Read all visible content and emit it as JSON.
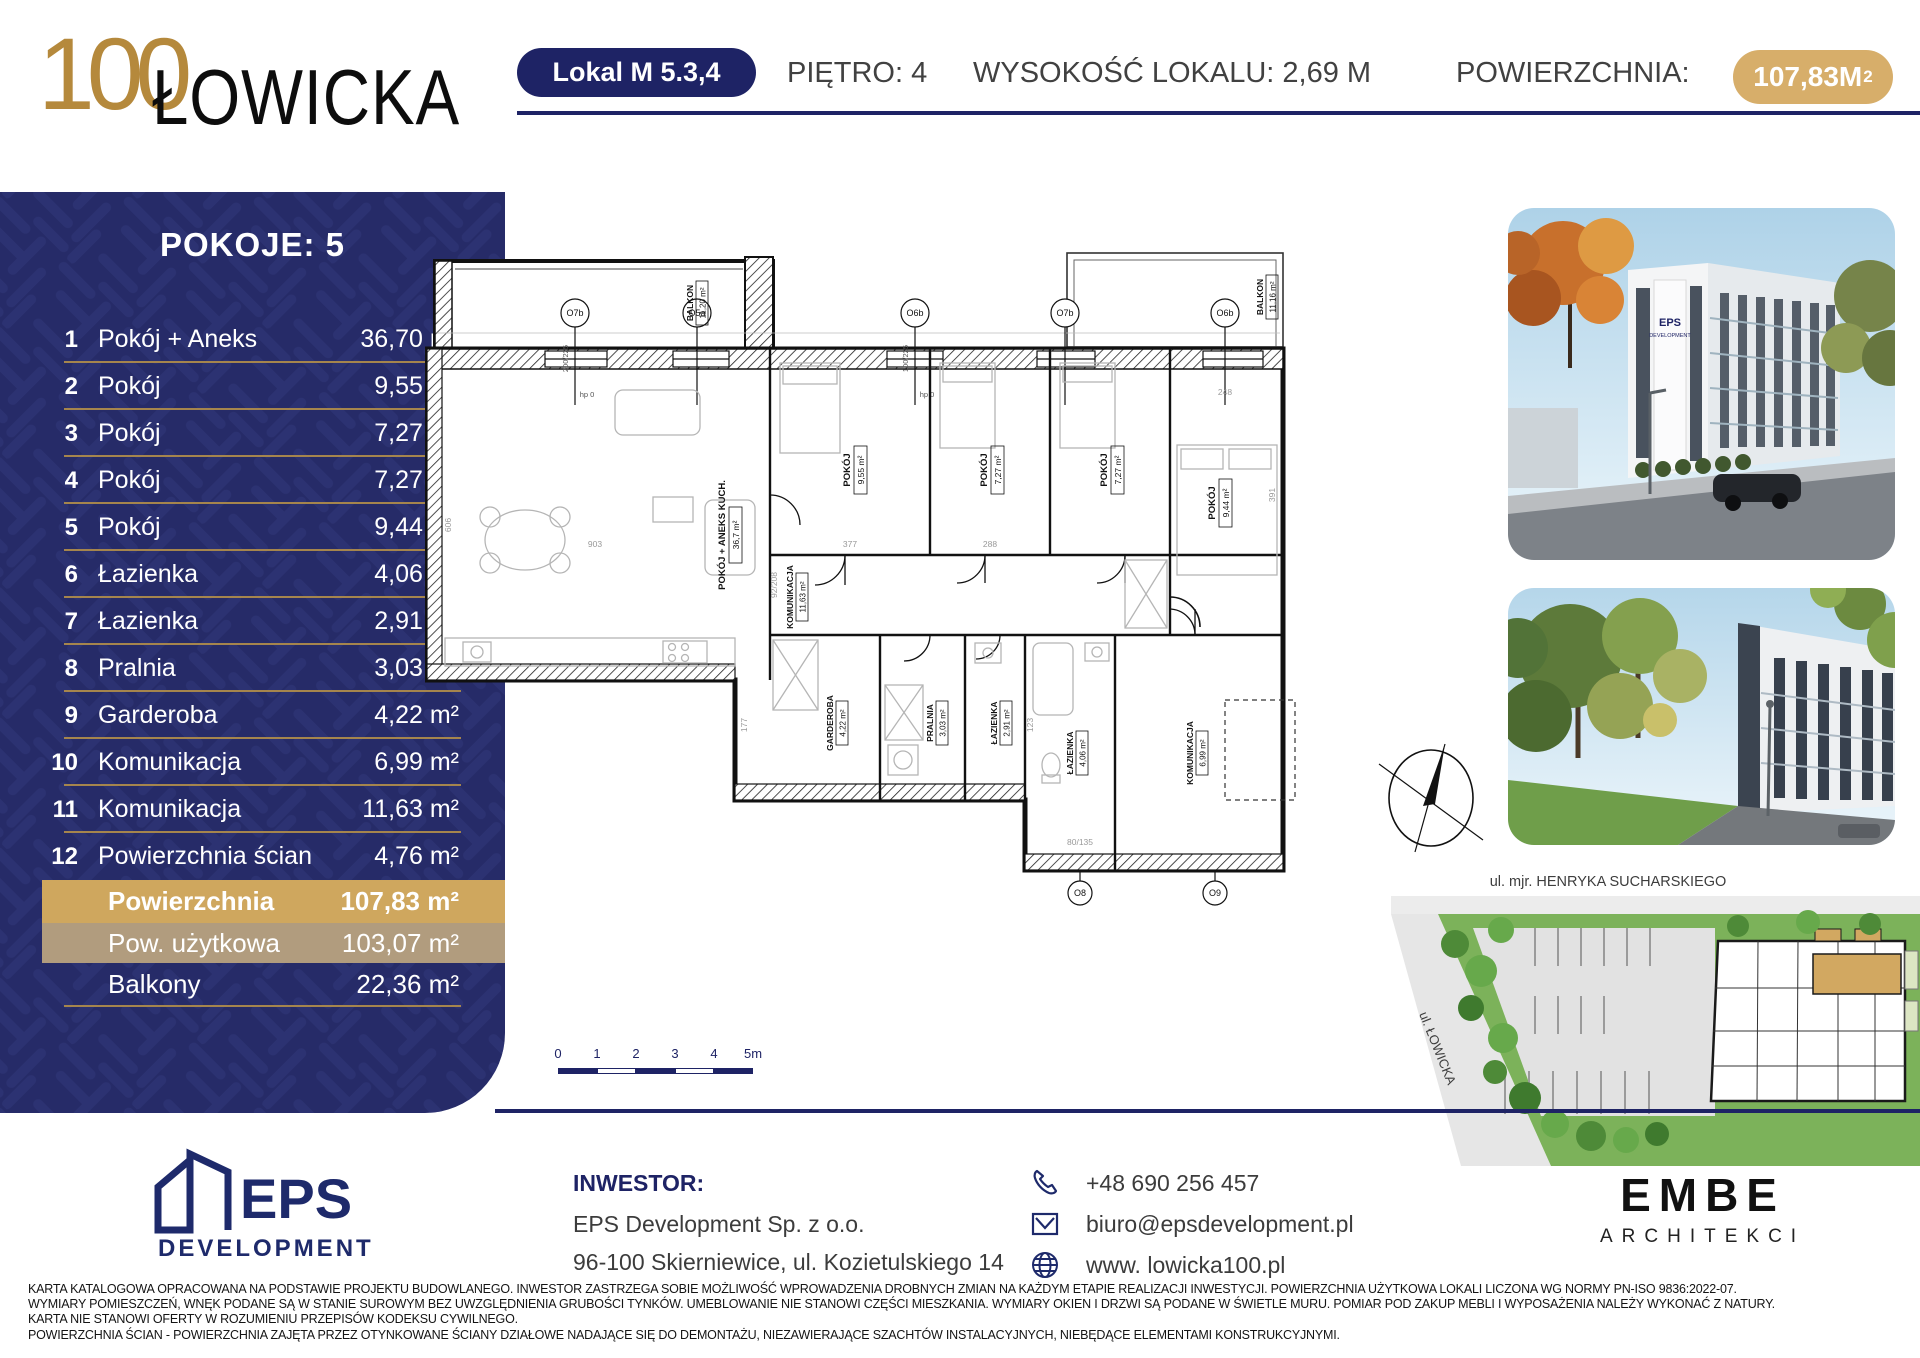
{
  "header": {
    "logo_top": "100",
    "logo_main": "ŁOWICKA",
    "unit_badge": "Lokal M 5.3,4",
    "floor": "PIĘTRO: 4",
    "height": "WYSOKOŚĆ LOKALU: 2,69 M",
    "area_label": "POWIERZCHNIA:",
    "area_value": "107,83M",
    "area_sup": "2"
  },
  "sidebar": {
    "title": "POKOJE: 5",
    "rows": [
      {
        "no": "1",
        "name": "Pokój + Aneks",
        "value": "36,70 m²"
      },
      {
        "no": "2",
        "name": "Pokój",
        "value": "9,55 m²"
      },
      {
        "no": "3",
        "name": "Pokój",
        "value": "7,27 m²"
      },
      {
        "no": "4",
        "name": "Pokój",
        "value": "7,27 m²"
      },
      {
        "no": "5",
        "name": "Pokój",
        "value": "9,44 m²"
      },
      {
        "no": "6",
        "name": "Łazienka",
        "value": "4,06 m²"
      },
      {
        "no": "7",
        "name": "Łazienka",
        "value": "2,91 m²"
      },
      {
        "no": "8",
        "name": "Pralnia",
        "value": "3,03 m²"
      },
      {
        "no": "9",
        "name": "Garderoba",
        "value": "4,22 m²"
      },
      {
        "no": "10",
        "name": "Komunikacja",
        "value": "6,99 m²"
      },
      {
        "no": "11",
        "name": "Komunikacja",
        "value": "11,63 m²"
      },
      {
        "no": "12",
        "name": "Powierzchnia ścian",
        "value": "4,76 m²"
      }
    ],
    "summary": {
      "area_label": "Powierzchnia",
      "area_value": "107,83 m²",
      "usable_label": "Pow. użytkowa",
      "usable_value": "103,07 m²",
      "balcony_label": "Balkony",
      "balcony_value": "22,36 m²"
    }
  },
  "plan": {
    "rooms": [
      {
        "name": "POKÓJ + ANEKS KUCH.",
        "area": "36,7 m²"
      },
      {
        "name": "POKÓJ",
        "area": "9,55 m²"
      },
      {
        "name": "POKÓJ",
        "area": "7,27 m²"
      },
      {
        "name": "POKÓJ",
        "area": "7,27 m²"
      },
      {
        "name": "POKÓJ",
        "area": "9,44 m²"
      },
      {
        "name": "KOMUNIKACJA",
        "area": "11,63 m²"
      },
      {
        "name": "GARDEROBA",
        "area": "4,22 m²"
      },
      {
        "name": "PRALNIA",
        "area": "3,03 m²"
      },
      {
        "name": "ŁAZIENKA",
        "area": "2,91 m²"
      },
      {
        "name": "ŁAZIENKA",
        "area": "4,06 m²"
      },
      {
        "name": "KOMUNIKACJA",
        "area": "6,99 m²"
      }
    ],
    "balconies": [
      {
        "name": "BALKON",
        "area": "11,20 m²"
      },
      {
        "name": "BALKON",
        "area": "11,16 m²"
      }
    ],
    "windows_top": [
      "O7b",
      "O5a",
      "O6b",
      "O7b",
      "O6b"
    ],
    "windows_bottom": [
      "O8",
      "O9"
    ],
    "win_dims": [
      "200/225",
      "100/225"
    ],
    "hp": "hp 0",
    "dims": [
      "903",
      "606",
      "377",
      "288",
      "248",
      "391",
      "177",
      "123",
      "92/208",
      "80/135"
    ]
  },
  "scalebar": {
    "labels": [
      "0",
      "1",
      "2",
      "3",
      "4",
      "5m"
    ]
  },
  "site": {
    "street_top": "ul. mjr. HENRYKA SUCHARSKIEGO",
    "street_left": "ul. ŁOWICKA"
  },
  "photos": {
    "sign_line1": "EPS",
    "sign_line2": "DEVELOPMENT"
  },
  "footer": {
    "eps_name": "EPS",
    "eps_sub": "DEVELOPMENT",
    "investor_label": "INWESTOR:",
    "investor_name": "EPS Development Sp. z o.o.",
    "investor_address": "96-100 Skierniewice, ul. Kozietulskiego 14",
    "phone": "+48 690 256 457",
    "email": "biuro@epsdevelopment.pl",
    "website": "www. lowicka100.pl",
    "embe_name": "EMBE",
    "embe_sub": "ARCHITEKCI"
  },
  "legal": {
    "line1": "KARTA KATALOGOWA OPRACOWANA NA PODSTAWIE PROJEKTU BUDOWLANEGO. INWESTOR ZASTRZEGA SOBIE MOŻLIWOŚĆ WPROWADZENIA DROBNYCH ZMIAN NA KAŻDYM ETAPIE REALIZACJI INWESTYCJI. POWIERZCHNIA UŻYTKOWA LOKALI LICZONA WG NORMY PN-ISO 9836:2022-07.",
    "line2": "WYMIARY POMIESZCZEŃ, WNĘK PODANE SĄ W STANIE SUROWYM BEZ UWZGLĘDNIENIA GRUBOŚCI TYNKÓW. UMEBLOWANIE NIE STANOWI CZĘŚCI MIESZKANIA. WYMIARY OKIEN I DRZWI SĄ PODANE W ŚWIETLE MURU. POMIAR POD ZAKUP MEBLI I WYPOSAŻENIA NALEŻY WYKONAĆ Z NATURY.",
    "line3": "KARTA NIE STANOWI OFERTY W ROZUMIENIU PRZEPISÓW KODEKSU CYWILNEGO.",
    "line4": "POWIERZCHNIA ŚCIAN - POWIERZCHNIA ZAJĘTA PRZEZ OTYNKOWANE ŚCIANY DZIAŁOWE NADAJĄCE SIĘ DO DEMONTAŻU, NIEZAWIERAJĄCE SZACHTÓW INSTALACYJNYCH, NIEBĘDĄCE ELEMENTAMI KONSTRUKCYJNYMI."
  },
  "colors": {
    "navy": "#1e2365",
    "gold": "#cfa75e",
    "tan": "#b19c7e",
    "gold_pill": "#d7ae6a"
  }
}
